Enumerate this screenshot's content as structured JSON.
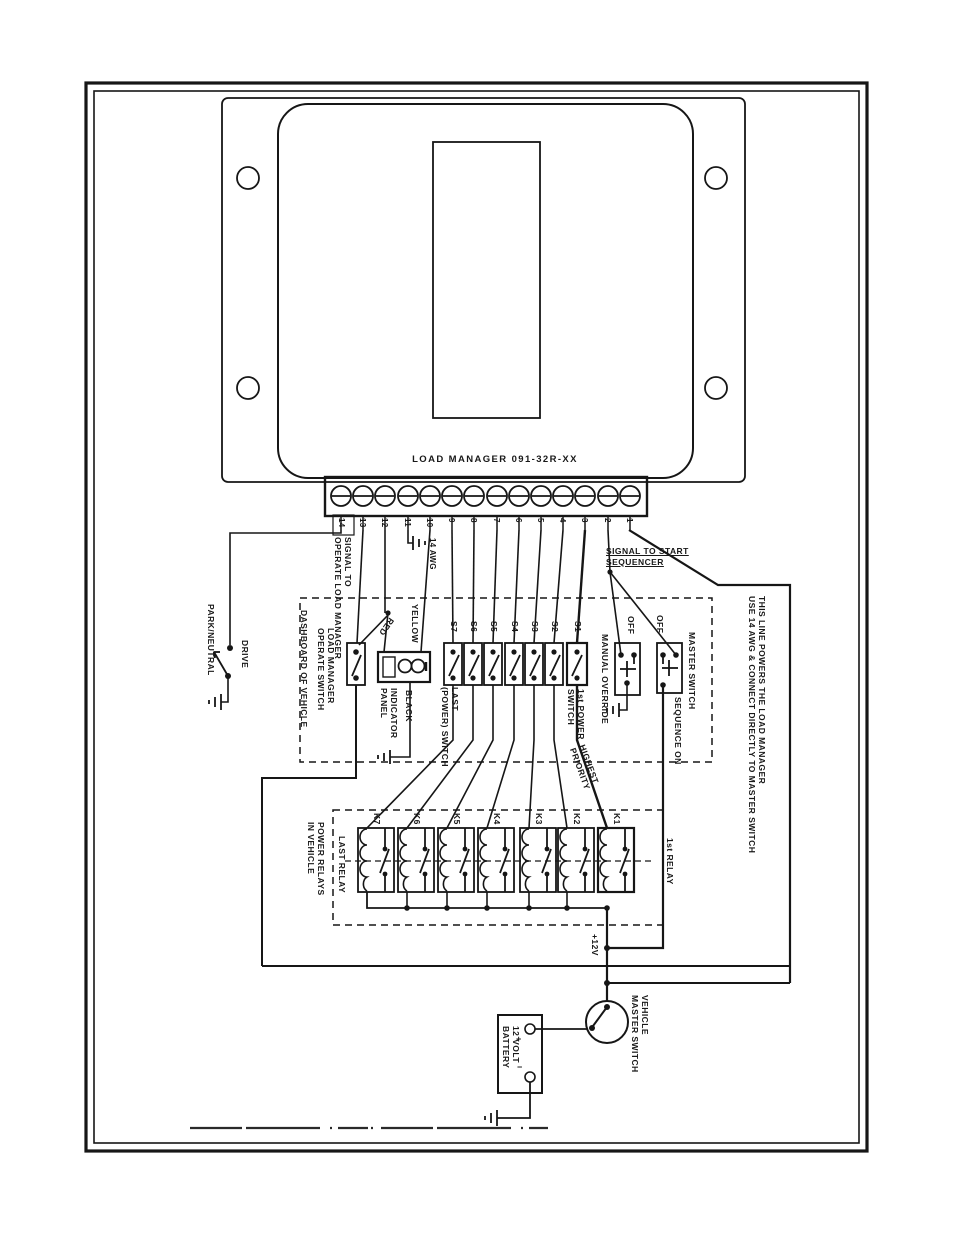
{
  "unit": {
    "label": "LOAD MANAGER 091-32R-XX"
  },
  "terminal_strip": {
    "numbers": [
      "14",
      "13",
      "12",
      "11",
      "10",
      "9",
      "8",
      "7",
      "6",
      "5",
      "4",
      "3",
      "2",
      "1"
    ],
    "wire_gauge_note": "14 AWG"
  },
  "left_section": {
    "signal_to_operate": "SIGNAL TO\nOPERATE LOAD MANAGER",
    "park_neutral": "PARK/NEUTRAL",
    "drive": "DRIVE"
  },
  "dashboard": {
    "label": "DASHBOARD OF VEHICLE",
    "operate_switch": "LOAD MANAGER\nOPERATE SWITCH",
    "indicator_panel": "INDICATOR\nPANEL",
    "wire_red": "RED",
    "wire_yellow": "YELLOW",
    "wire_black": "BLACK",
    "switch_ids": [
      "S7",
      "S6",
      "S5",
      "S4",
      "S3",
      "S2",
      "S1"
    ],
    "last_switch": "LAST\n(POWER) SWITCH",
    "first_switch": "1st POWER\nSWITCH",
    "manual_override": "MANUAL OVERRIDE",
    "manual_override_off": "OFF",
    "master_switch": "MASTER SWITCH",
    "master_switch_off": "OFF",
    "sequence_on": "SEQUENCE ON"
  },
  "sequencer": {
    "signal_to_start": "SIGNAL TO START\nSEQUENCER"
  },
  "power_note": "THIS LINE POWERS THE LOAD MANAGER\nUSE 14 AWG & CONNECT DIRECTLY TO MASTER SWITCH",
  "relays": {
    "section_label": "POWER RELAYS\nIN VEHICLE",
    "relay_ids": [
      "K7",
      "K6",
      "K5",
      "K4",
      "K3",
      "K2",
      "K1"
    ],
    "last_relay": "LAST RELAY",
    "first_relay": "1st RELAY",
    "highest_priority": "HIGHEST\nPRIORITY"
  },
  "power": {
    "plus_12v": "+12V",
    "vehicle_master_switch": "VEHICLE\nMASTER SWITCH",
    "battery": "12 VOLT\nBATTERY",
    "battery_plus": "+",
    "battery_minus": "−"
  },
  "colors": {
    "ink": "#161616",
    "paper": "#ffffff"
  }
}
